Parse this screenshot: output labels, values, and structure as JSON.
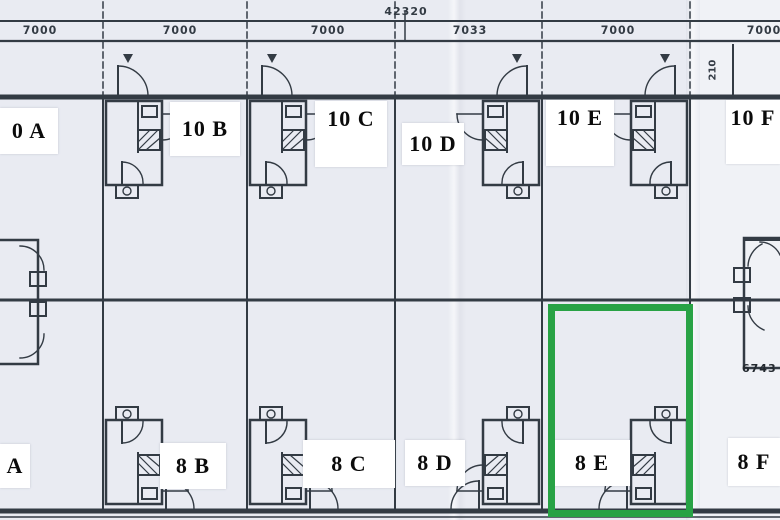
{
  "plan": {
    "description": "Scanned terraced-housing floor plan, two rows of units, unit 8 E highlighted",
    "highlight": {
      "unit": "8 E",
      "color": "#28a245"
    }
  },
  "dims": {
    "overall": "42320",
    "bays": [
      "7000",
      "7000",
      "7000",
      "7033",
      "7000",
      "7000"
    ],
    "side_note": "210",
    "right_note": "6743"
  },
  "units": {
    "top_row": [
      {
        "label": "0 A"
      },
      {
        "label": "10 B"
      },
      {
        "label": "10 C"
      },
      {
        "label": "10 D"
      },
      {
        "label": "10 E"
      },
      {
        "label": "10 F"
      }
    ],
    "bottom_row": [
      {
        "label": "A"
      },
      {
        "label": "8 B"
      },
      {
        "label": "8 C"
      },
      {
        "label": "8 D"
      },
      {
        "label": "8 E"
      },
      {
        "label": "8 F"
      }
    ]
  }
}
